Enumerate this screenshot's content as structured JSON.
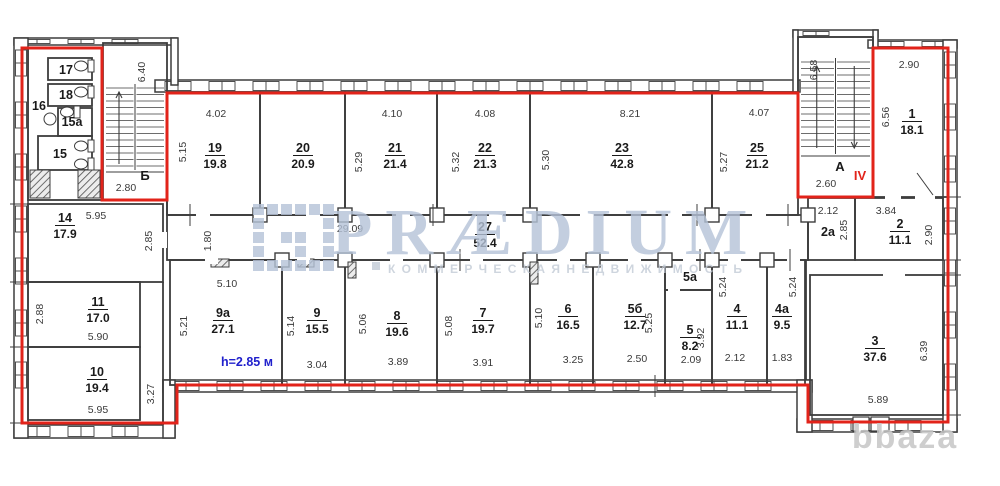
{
  "watermark": {
    "brand": "PRÆDIUM",
    "subtitle": "К О М М Е Р Ч Е С К А Я   Н Е Д В И Ж И М О С Т Ь",
    "corner": "bbaza"
  },
  "plan": {
    "height_note": "h=2.85 м",
    "floor_mark": "IV"
  },
  "colors": {
    "wall": "#3d3d3d",
    "text": "#1a1a1a",
    "dim": "#3a3a3a",
    "red": "#e2231a",
    "blue": "#2020cc",
    "watermark": "#b5c3d8",
    "subtitle": "#c3cbd6",
    "corner": "#c6c6c6"
  },
  "rooms": [
    {
      "num": "19",
      "area": "19.8",
      "x": 167,
      "y": 92,
      "w": 93,
      "h": 123,
      "lx": 215,
      "ly": 152
    },
    {
      "num": "20",
      "area": "20.9",
      "x": 260,
      "y": 92,
      "w": 85,
      "h": 123,
      "lx": 303,
      "ly": 152
    },
    {
      "num": "21",
      "area": "21.4",
      "x": 345,
      "y": 92,
      "w": 92,
      "h": 123,
      "lx": 395,
      "ly": 152
    },
    {
      "num": "22",
      "area": "21.3",
      "x": 437,
      "y": 92,
      "w": 93,
      "h": 123,
      "lx": 485,
      "ly": 152
    },
    {
      "num": "23",
      "area": "42.8",
      "x": 530,
      "y": 92,
      "w": 182,
      "h": 123,
      "lx": 622,
      "ly": 152
    },
    {
      "num": "25",
      "area": "21.2",
      "x": 712,
      "y": 92,
      "w": 86,
      "h": 123,
      "lx": 757,
      "ly": 152
    },
    {
      "num": "1",
      "area": "18.1",
      "x": 873,
      "y": 48,
      "w": 75,
      "h": 149,
      "lx": 912,
      "ly": 118
    },
    {
      "num": "2a",
      "area": "",
      "x": 808,
      "y": 198,
      "w": 47,
      "h": 62,
      "lx": 828,
      "ly": 236
    },
    {
      "num": "2",
      "area": "11.1",
      "x": 855,
      "y": 198,
      "w": 88,
      "h": 62,
      "lx": 900,
      "ly": 228
    },
    {
      "num": "27",
      "area": "52.4",
      "x": 167,
      "y": 215,
      "w": 641,
      "h": 45,
      "lx": 485,
      "ly": 231
    },
    {
      "num": "14",
      "area": "17.9",
      "x": 28,
      "y": 204,
      "w": 135,
      "h": 78,
      "lx": 65,
      "ly": 222
    },
    {
      "num": "11",
      "area": "17.0",
      "x": 28,
      "y": 282,
      "w": 112,
      "h": 65,
      "lx": 98,
      "ly": 306
    },
    {
      "num": "10",
      "area": "19.4",
      "x": 28,
      "y": 347,
      "w": 112,
      "h": 73,
      "lx": 97,
      "ly": 376
    },
    {
      "num": "9a",
      "area": "27.1",
      "x": 170,
      "y": 260,
      "w": 112,
      "h": 125,
      "lx": 223,
      "ly": 317
    },
    {
      "num": "9",
      "area": "15.5",
      "x": 282,
      "y": 260,
      "w": 63,
      "h": 125,
      "lx": 317,
      "ly": 317
    },
    {
      "num": "8",
      "area": "19.6",
      "x": 345,
      "y": 260,
      "w": 92,
      "h": 125,
      "lx": 397,
      "ly": 320
    },
    {
      "num": "7",
      "area": "19.7",
      "x": 437,
      "y": 260,
      "w": 93,
      "h": 125,
      "lx": 483,
      "ly": 317
    },
    {
      "num": "6",
      "area": "16.5",
      "x": 530,
      "y": 260,
      "w": 63,
      "h": 125,
      "lx": 568,
      "ly": 313
    },
    {
      "num": "5б",
      "area": "12.7",
      "x": 593,
      "y": 260,
      "w": 72,
      "h": 125,
      "lx": 635,
      "ly": 313
    },
    {
      "num": "5a",
      "area": "",
      "x": 665,
      "y": 260,
      "w": 47,
      "h": 30,
      "lx": 690,
      "ly": 281
    },
    {
      "num": "5",
      "area": "8.2",
      "x": 665,
      "y": 290,
      "w": 47,
      "h": 95,
      "lx": 690,
      "ly": 334
    },
    {
      "num": "4",
      "area": "11.1",
      "x": 712,
      "y": 260,
      "w": 55,
      "h": 125,
      "lx": 737,
      "ly": 313
    },
    {
      "num": "4a",
      "area": "9.5",
      "x": 767,
      "y": 260,
      "w": 38,
      "h": 125,
      "lx": 782,
      "ly": 313
    },
    {
      "num": "3",
      "area": "37.6",
      "x": 810,
      "y": 275,
      "w": 133,
      "h": 140,
      "lx": 875,
      "ly": 345
    },
    {
      "num": "17",
      "area": "",
      "x": 48,
      "y": 58,
      "w": 44,
      "h": 22,
      "lx": 66,
      "ly": 74
    },
    {
      "num": "18",
      "area": "",
      "x": 48,
      "y": 84,
      "w": 44,
      "h": 22,
      "lx": 66,
      "ly": 99
    },
    {
      "num": "15a",
      "area": "",
      "x": 58,
      "y": 108,
      "w": 34,
      "h": 28,
      "lx": 72,
      "ly": 126
    },
    {
      "num": "15",
      "area": "",
      "x": 38,
      "y": 136,
      "w": 54,
      "h": 34,
      "lx": 60,
      "ly": 158
    },
    {
      "num": "16",
      "area": "",
      "lx": 39,
      "ly": 110
    }
  ],
  "stairs": [
    {
      "label": "Б",
      "x": 103,
      "y": 43,
      "w": 64,
      "h": 157,
      "lx": 145,
      "ly": 180,
      "t1": 88,
      "t2": 166,
      "landing": 172,
      "arrows": "up"
    },
    {
      "label": "А",
      "x": 798,
      "y": 37,
      "w": 75,
      "h": 160,
      "lx": 840,
      "ly": 171,
      "t1": 62,
      "t2": 150,
      "landing": 156,
      "arrows": "updown"
    }
  ],
  "dims": [
    {
      "t": "4.02",
      "x": 216,
      "y": 117
    },
    {
      "t": "5.15",
      "x": 186,
      "y": 152,
      "r": 1
    },
    {
      "t": "4.10",
      "x": 392,
      "y": 117
    },
    {
      "t": "5.29",
      "x": 362,
      "y": 162,
      "r": 1
    },
    {
      "t": "4.08",
      "x": 485,
      "y": 117
    },
    {
      "t": "5.32",
      "x": 459,
      "y": 162,
      "r": 1
    },
    {
      "t": "8.21",
      "x": 630,
      "y": 117
    },
    {
      "t": "5.30",
      "x": 549,
      "y": 160,
      "r": 1
    },
    {
      "t": "4.07",
      "x": 759,
      "y": 116
    },
    {
      "t": "5.27",
      "x": 727,
      "y": 162,
      "r": 1
    },
    {
      "t": "6.40",
      "x": 145,
      "y": 72,
      "r": 1
    },
    {
      "t": "2.80",
      "x": 126,
      "y": 191
    },
    {
      "t": "6.58",
      "x": 817,
      "y": 70,
      "r": 1
    },
    {
      "t": "2.60",
      "x": 826,
      "y": 187
    },
    {
      "t": "2.90",
      "x": 909,
      "y": 68
    },
    {
      "t": "6.56",
      "x": 889,
      "y": 117,
      "r": 1
    },
    {
      "t": "2.12",
      "x": 828,
      "y": 214
    },
    {
      "t": "2.85",
      "x": 847,
      "y": 230,
      "r": 1
    },
    {
      "t": "3.84",
      "x": 886,
      "y": 214
    },
    {
      "t": "2.90",
      "x": 932,
      "y": 235,
      "r": 1
    },
    {
      "t": "29.09",
      "x": 350,
      "y": 232
    },
    {
      "t": "1.80",
      "x": 211,
      "y": 241,
      "r": 1
    },
    {
      "t": "5.95",
      "x": 96,
      "y": 219
    },
    {
      "t": "2.85",
      "x": 152,
      "y": 241,
      "r": 1
    },
    {
      "t": "2.88",
      "x": 43,
      "y": 314,
      "r": 1
    },
    {
      "t": "5.90",
      "x": 98,
      "y": 340
    },
    {
      "t": "5.95",
      "x": 98,
      "y": 413
    },
    {
      "t": "3.27",
      "x": 154,
      "y": 394,
      "r": 1
    },
    {
      "t": "5.10",
      "x": 227,
      "y": 287
    },
    {
      "t": "5.21",
      "x": 187,
      "y": 326,
      "r": 1
    },
    {
      "t": "5.14",
      "x": 294,
      "y": 326,
      "r": 1
    },
    {
      "t": "3.04",
      "x": 317,
      "y": 368
    },
    {
      "t": "5.06",
      "x": 366,
      "y": 324,
      "r": 1
    },
    {
      "t": "3.89",
      "x": 398,
      "y": 365
    },
    {
      "t": "5.08",
      "x": 452,
      "y": 326,
      "r": 1
    },
    {
      "t": "3.91",
      "x": 483,
      "y": 366
    },
    {
      "t": "5.10",
      "x": 542,
      "y": 318,
      "r": 1
    },
    {
      "t": "3.25",
      "x": 573,
      "y": 363
    },
    {
      "t": "5.25",
      "x": 652,
      "y": 323,
      "r": 1
    },
    {
      "t": "2.50",
      "x": 637,
      "y": 362
    },
    {
      "t": "3.92",
      "x": 704,
      "y": 338,
      "r": 1
    },
    {
      "t": "2.09",
      "x": 691,
      "y": 363
    },
    {
      "t": "5.24",
      "x": 726,
      "y": 287,
      "r": 1
    },
    {
      "t": "2.12",
      "x": 735,
      "y": 361
    },
    {
      "t": "5.24",
      "x": 796,
      "y": 287,
      "r": 1
    },
    {
      "t": "1.83",
      "x": 782,
      "y": 361
    },
    {
      "t": "6.39",
      "x": 927,
      "y": 351,
      "r": 1
    },
    {
      "t": "5.89",
      "x": 878,
      "y": 403
    }
  ],
  "red_outline": {
    "points": [
      [
        22,
        48
      ],
      [
        102,
        48
      ],
      [
        102,
        200
      ],
      [
        167,
        200
      ],
      [
        167,
        93
      ],
      [
        798,
        93
      ],
      [
        798,
        197
      ],
      [
        873,
        197
      ],
      [
        873,
        48
      ],
      [
        948,
        48
      ],
      [
        948,
        422
      ],
      [
        808,
        422
      ],
      [
        808,
        385
      ],
      [
        177,
        385
      ],
      [
        177,
        423
      ],
      [
        22,
        423
      ]
    ]
  }
}
